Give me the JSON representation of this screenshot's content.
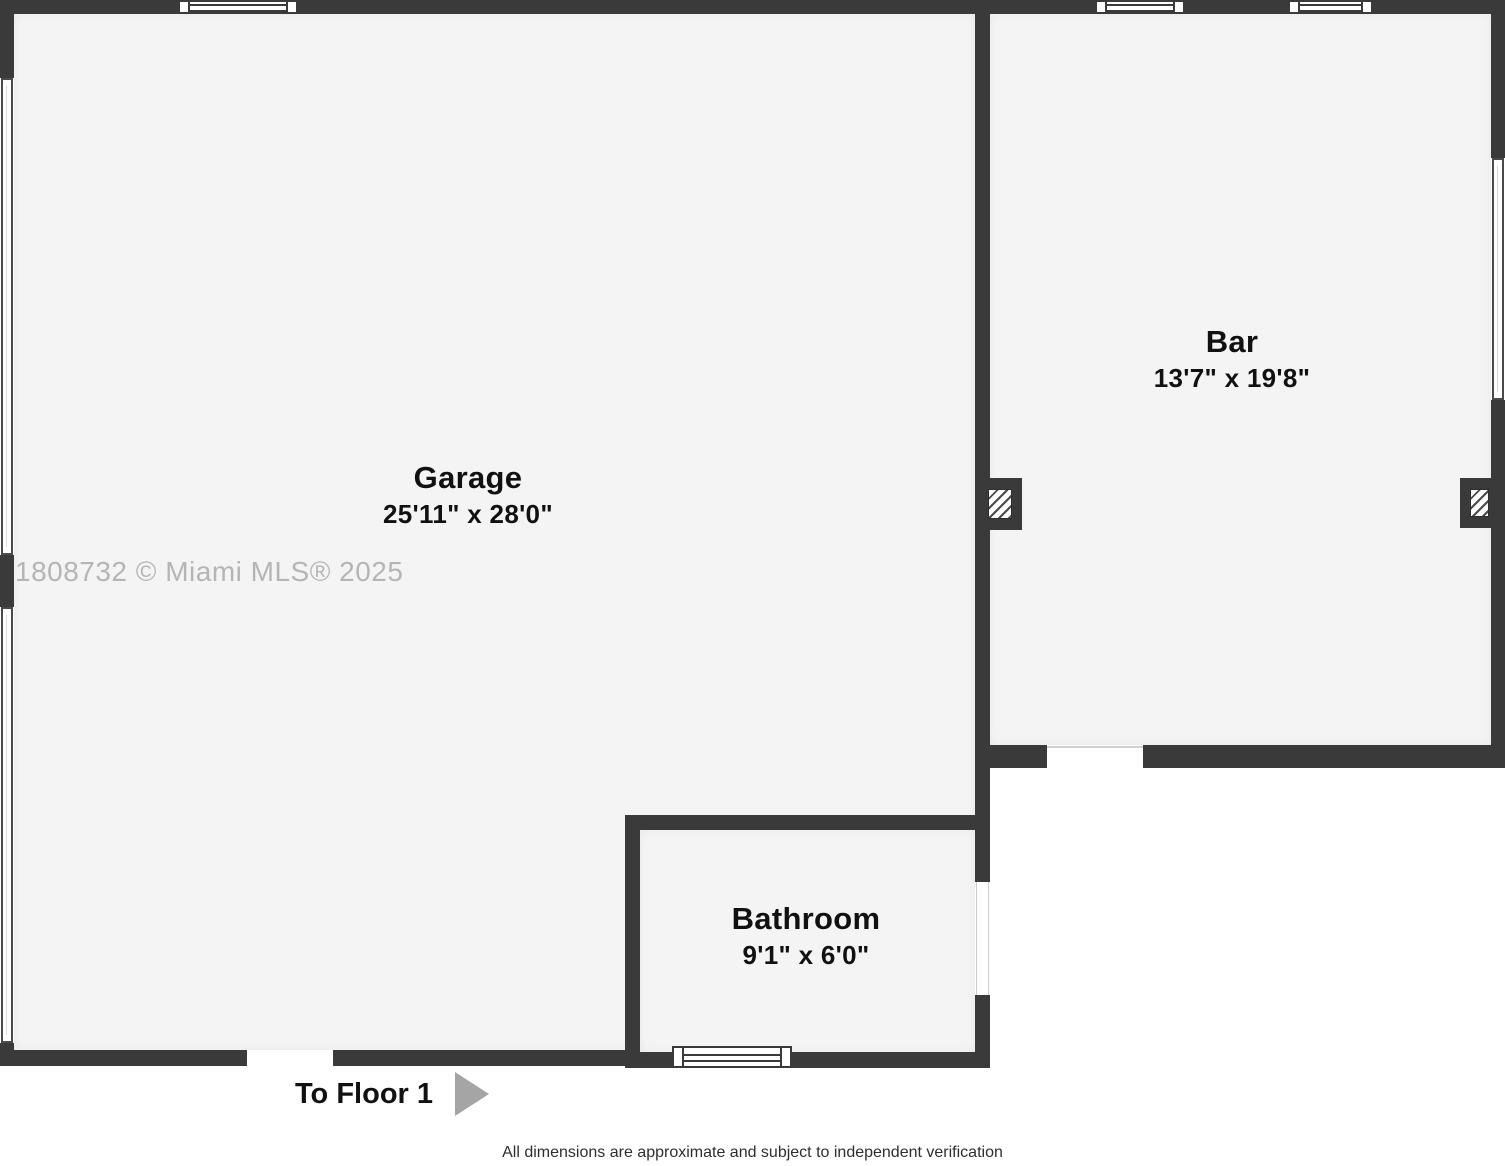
{
  "floorplan": {
    "rooms": [
      {
        "name": "Garage",
        "dimensions": "25'11\" x 28'0\""
      },
      {
        "name": "Bar",
        "dimensions": "13'7\" x 19'8\""
      },
      {
        "name": "Bathroom",
        "dimensions": "9'1\" x 6'0\""
      }
    ],
    "navigation": {
      "to_floor_label": "To Floor 1",
      "arrow_icon": "right-triangle-arrow"
    },
    "watermark": "1808732 © Miami MLS® 2025",
    "footer": "All dimensions are approximate and subject to independent verification",
    "colors": {
      "wall": "#3a3a3a",
      "room_fill": "#f4f4f4",
      "outside": "#ffffff",
      "watermark": "#b5b5b5",
      "arrow": "#a5a5a5",
      "label_text": "#111111"
    }
  }
}
